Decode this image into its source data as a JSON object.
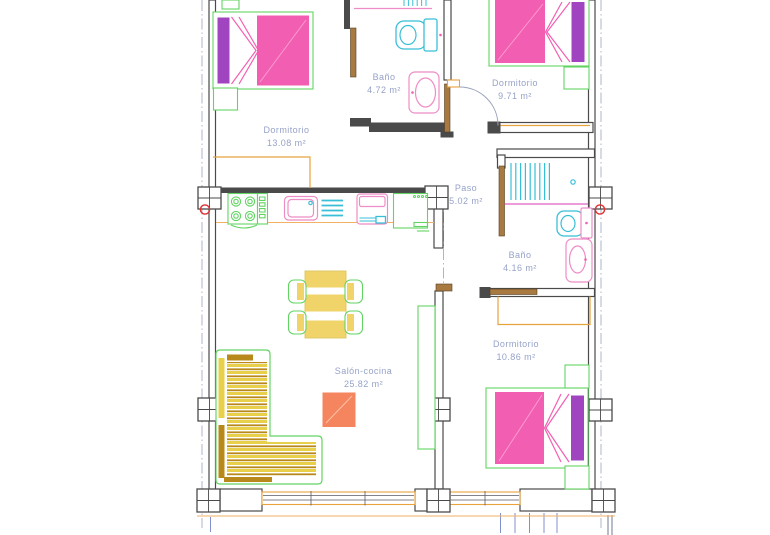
{
  "plan": {
    "rooms": [
      {
        "name": "Dormitorio",
        "area": "13.08 m²"
      },
      {
        "name": "Baño",
        "area": "4.72 m²"
      },
      {
        "name": "Dormitorio",
        "area": "9.71 m²"
      },
      {
        "name": "Paso",
        "area": "5.02 m²"
      },
      {
        "name": "Baño",
        "area": "4.16 m²"
      },
      {
        "name": "Dormitorio",
        "area": "10.86 m²"
      },
      {
        "name": "Salón-cocina",
        "area": "25.82 m²"
      }
    ]
  },
  "colors": {
    "wall": "#4a4a4a",
    "label_text": "#96a2c8",
    "bed_pink": "#f25fb2",
    "pillow_purple": "#a044c0",
    "furniture_green": "#63d463",
    "fixture_cyan": "#38bfd8",
    "fixture_pink": "#ee8cc6",
    "wood_orange": "#e8a33d",
    "counter_orange": "#f2b266",
    "sofa_yellow": "#e9d04a",
    "sofa_gold": "#b8881b",
    "table_yellow": "#f0d469",
    "table_orange": "#f4855e",
    "accent_red": "#e03030",
    "dim_blue": "#8090cc",
    "centerline": "#9aa2bd",
    "door_brown": "#a87a42"
  }
}
